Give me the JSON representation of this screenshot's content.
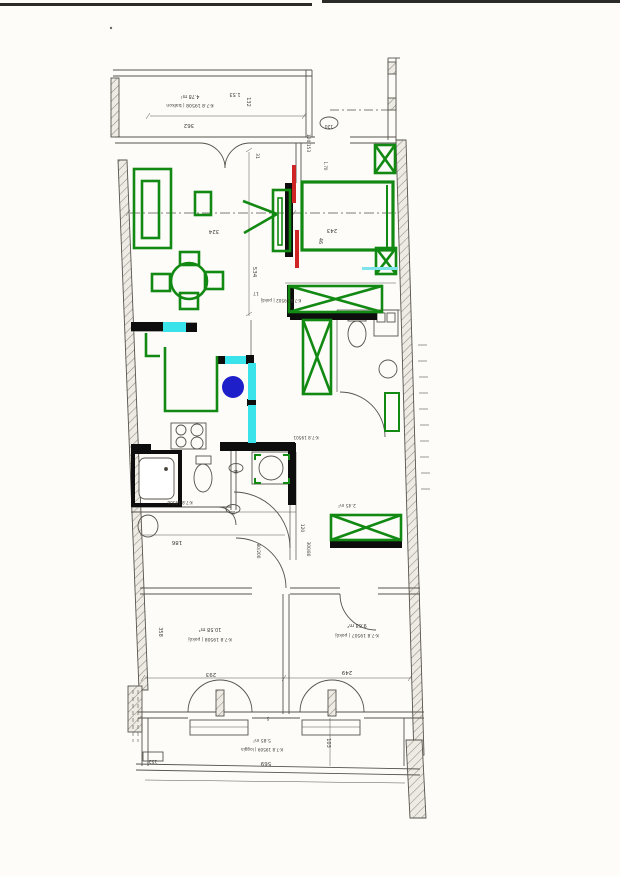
{
  "stamps": {
    "balcony_area": "4.78 m²",
    "balcony_id": "K-7.8 19508 | balkon",
    "living_id": "K-7.8 19502 | pokój",
    "living_area": "17",
    "bathroom_id": "K-7.8 19506",
    "wc_id": "K-7.8 19501",
    "hall_area": "2.45 m²",
    "room_left_area": "10.58 m²",
    "room_left_id": "K-7.8 19508 | pokój",
    "room_right_area": "9.63 m²",
    "room_right_id": "K-7.8 19507 | pokój",
    "loggia_area": "5.85 m²",
    "loggia_id": "K-7.8 19509 | loggia"
  },
  "dims": {
    "d362": "362",
    "d153": "1.53",
    "d132": "132",
    "d120oval": "120",
    "d120_153": "120/153",
    "d170": "1.70",
    "d31": "31",
    "d324": "324",
    "d534": "534",
    "d243": "243",
    "d46": "46",
    "d186": "186",
    "d40": "40",
    "d60": "60",
    "d80_200": "80/200",
    "d120h": "120",
    "d300_80": "300/80",
    "d358": "358",
    "d293": "293",
    "d249": "249",
    "d569": "569",
    "d103": "103",
    "d152": "152",
    "d5": "5"
  },
  "annotation_colors": {
    "furniture_marker_green": "#128912",
    "highlight_cyan": "#3ae2ea",
    "dot_blue": "#1f1fc9",
    "accent_red": "#d02525",
    "wall_marker_black": "#0d0d0d"
  }
}
